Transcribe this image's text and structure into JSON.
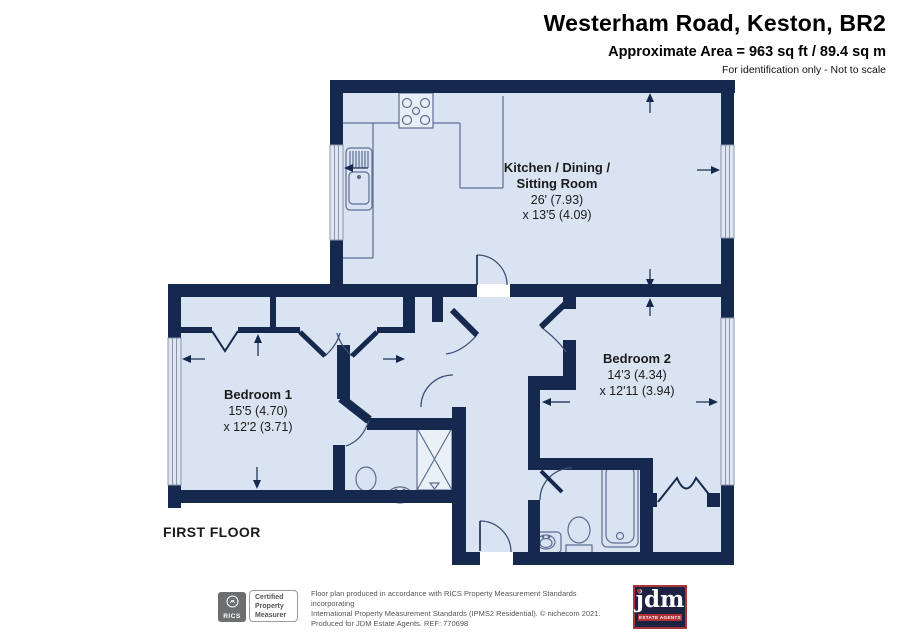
{
  "header": {
    "title": "Westerham Road, Keston, BR2",
    "area_line": "Approximate Area = 963 sq ft / 89.4 sq m",
    "disclaimer": "For identification only - Not to scale"
  },
  "floor_label": "FIRST FLOOR",
  "rooms": {
    "kitchen": {
      "name_line1": "Kitchen / Dining /",
      "name_line2": "Sitting Room",
      "dim_line1": "26' (7.93)",
      "dim_line2": "x 13'5 (4.09)"
    },
    "bedroom1": {
      "name": "Bedroom 1",
      "dim_line1": "15'5 (4.70)",
      "dim_line2": "x 12'2 (3.71)"
    },
    "bedroom2": {
      "name": "Bedroom 2",
      "dim_line1": "14'3 (4.34)",
      "dim_line2": "x 12'11 (3.94)"
    }
  },
  "footer": {
    "cert_line1": "Certified",
    "cert_line2": "Property",
    "cert_line3": "Measurer",
    "rics_label": "RICS",
    "line1": "Floor plan produced in accordance with RICS Property Measurement Standards incorporating",
    "line2": "International Property Measurement Standards (IPMS2 Residential).  © nichecom 2021.",
    "line3": "Produced for JDM Estate Agents.   REF: 770698",
    "jdm_label": "jdm",
    "jdm_sub": "ESTATE AGENTS"
  },
  "colors": {
    "wall_navy": "#15294e",
    "room_fill": "#d9e3f1",
    "window_line": "#8b95ab",
    "fixture_line": "#5d6e92",
    "logo_navy": "#1c2342",
    "logo_red": "#b03338"
  }
}
